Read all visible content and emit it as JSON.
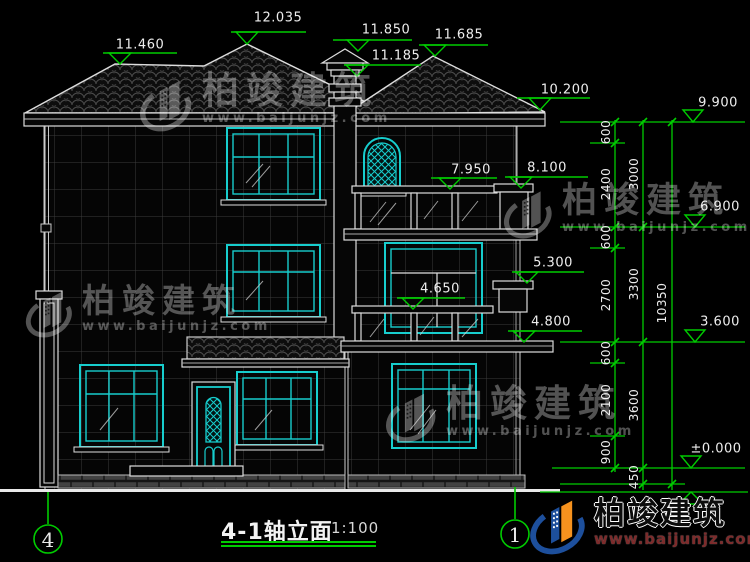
{
  "drawing": {
    "title": "4-1轴立面",
    "scale": "1:100",
    "axis_bubbles": [
      "4",
      "1"
    ],
    "building_levels": [
      "11.460",
      "12.035",
      "11.850",
      "11.185",
      "11.685",
      "10.200",
      "7.950",
      "8.100",
      "5.300",
      "4.650",
      "4.800"
    ],
    "datum_levels": [
      "9.900",
      "6.900",
      "3.600",
      "±0.000"
    ],
    "dim_inner": [
      "600",
      "2400",
      "600",
      "2700",
      "600",
      "2100",
      "900"
    ],
    "dim_middle": [
      "3000",
      "3300",
      "3600",
      "450"
    ],
    "dim_total": "10350"
  },
  "watermark": {
    "brand": "柏竣建筑",
    "url": "www.baijunjz.com"
  },
  "colors": {
    "background": "#000000",
    "line_white": "#e2e2e2",
    "glazing_cyan": "#17cdcd",
    "annotation_green": "#00cc00",
    "logo_blue": "#1d4f9c",
    "logo_orange": "#f6921e"
  }
}
